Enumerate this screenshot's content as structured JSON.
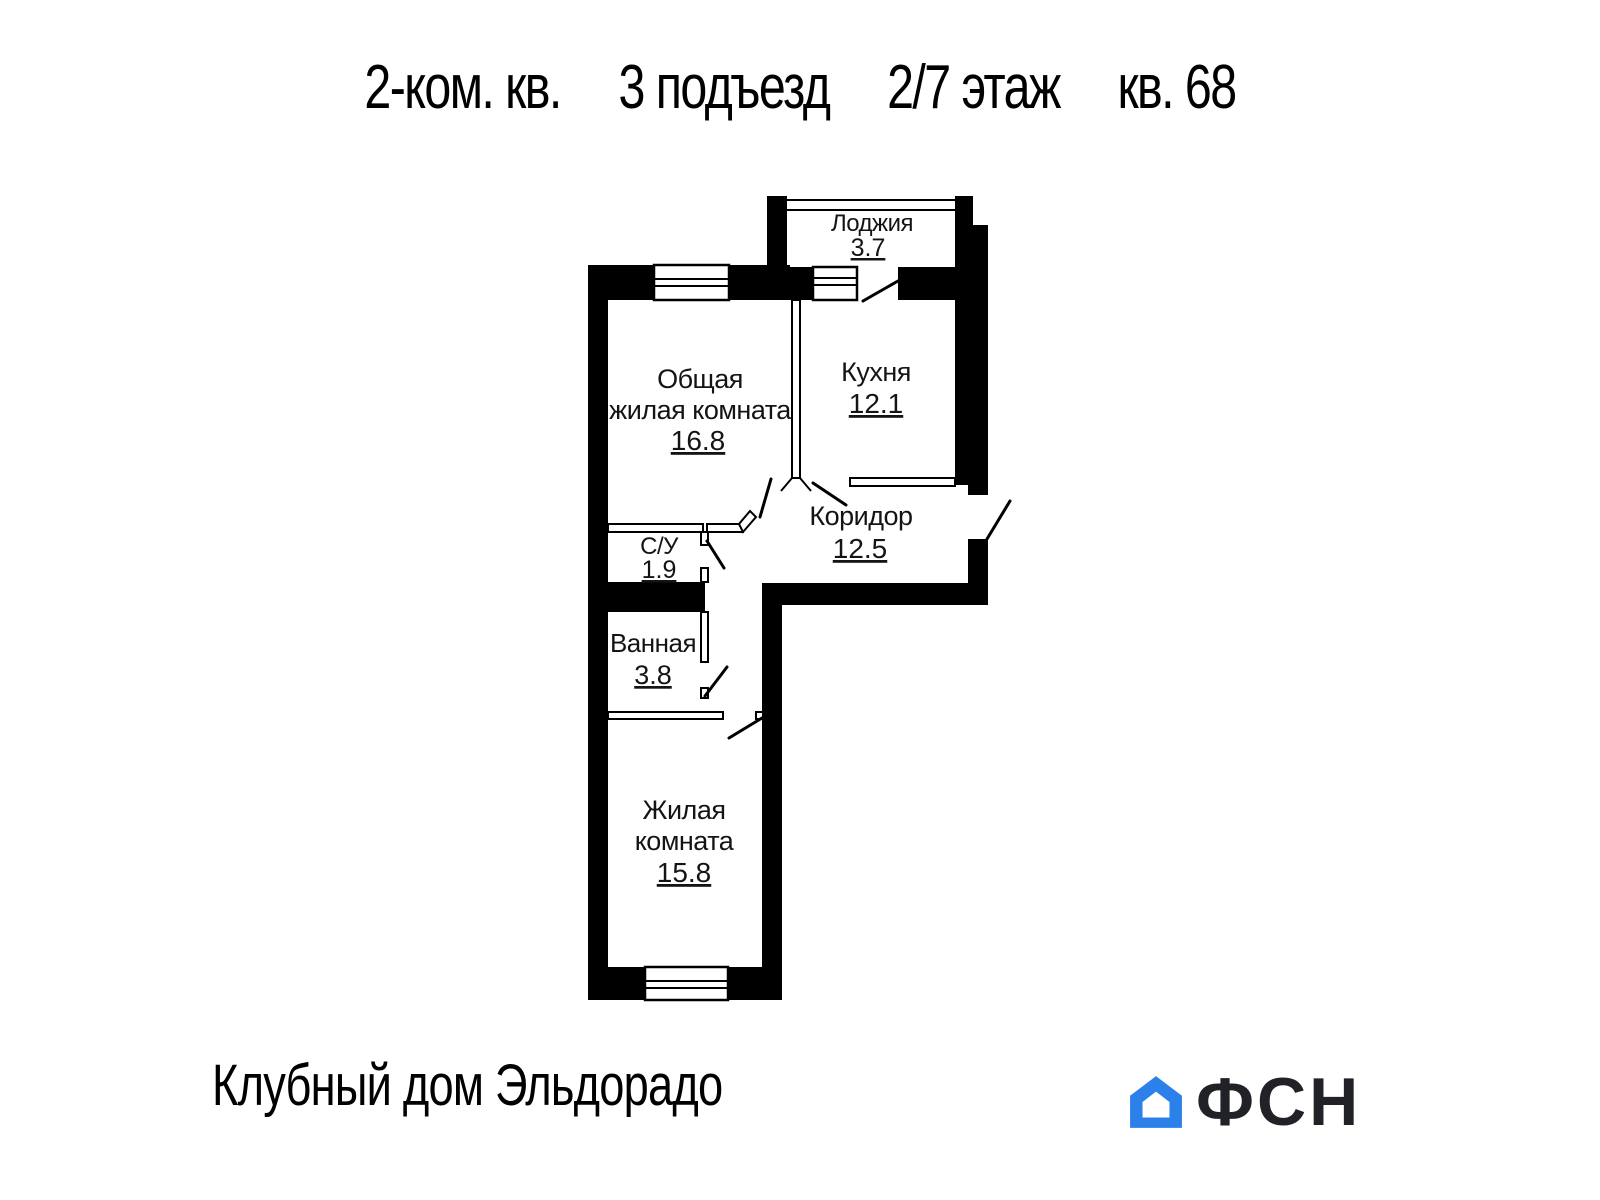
{
  "header": {
    "segments": [
      "2-ком. кв.",
      "3 подъезд",
      "2/7 этаж",
      "кв. 68"
    ]
  },
  "plan": {
    "loggia": {
      "label": "Лоджия",
      "area": "3.7"
    },
    "living_main": {
      "label1": "Общая",
      "label2": "жилая комната",
      "area": "16.8"
    },
    "kitchen": {
      "label": "Кухня",
      "area": "12.1"
    },
    "corridor": {
      "label": "Коридор",
      "area": "12.5"
    },
    "wc": {
      "label": "С/У",
      "area": "1.9"
    },
    "bathroom": {
      "label": "Ванная",
      "area": "3.8"
    },
    "living_second": {
      "label1": "Жилая",
      "label2": "комната",
      "area": "15.8"
    }
  },
  "footer": {
    "brand": "Клубный дом Эльдорадо",
    "logo_text": "ФСН"
  },
  "colors": {
    "wall": "#000000",
    "text": "#141414",
    "logo_blue": "#2b80ea",
    "logo_ink": "#202227"
  }
}
